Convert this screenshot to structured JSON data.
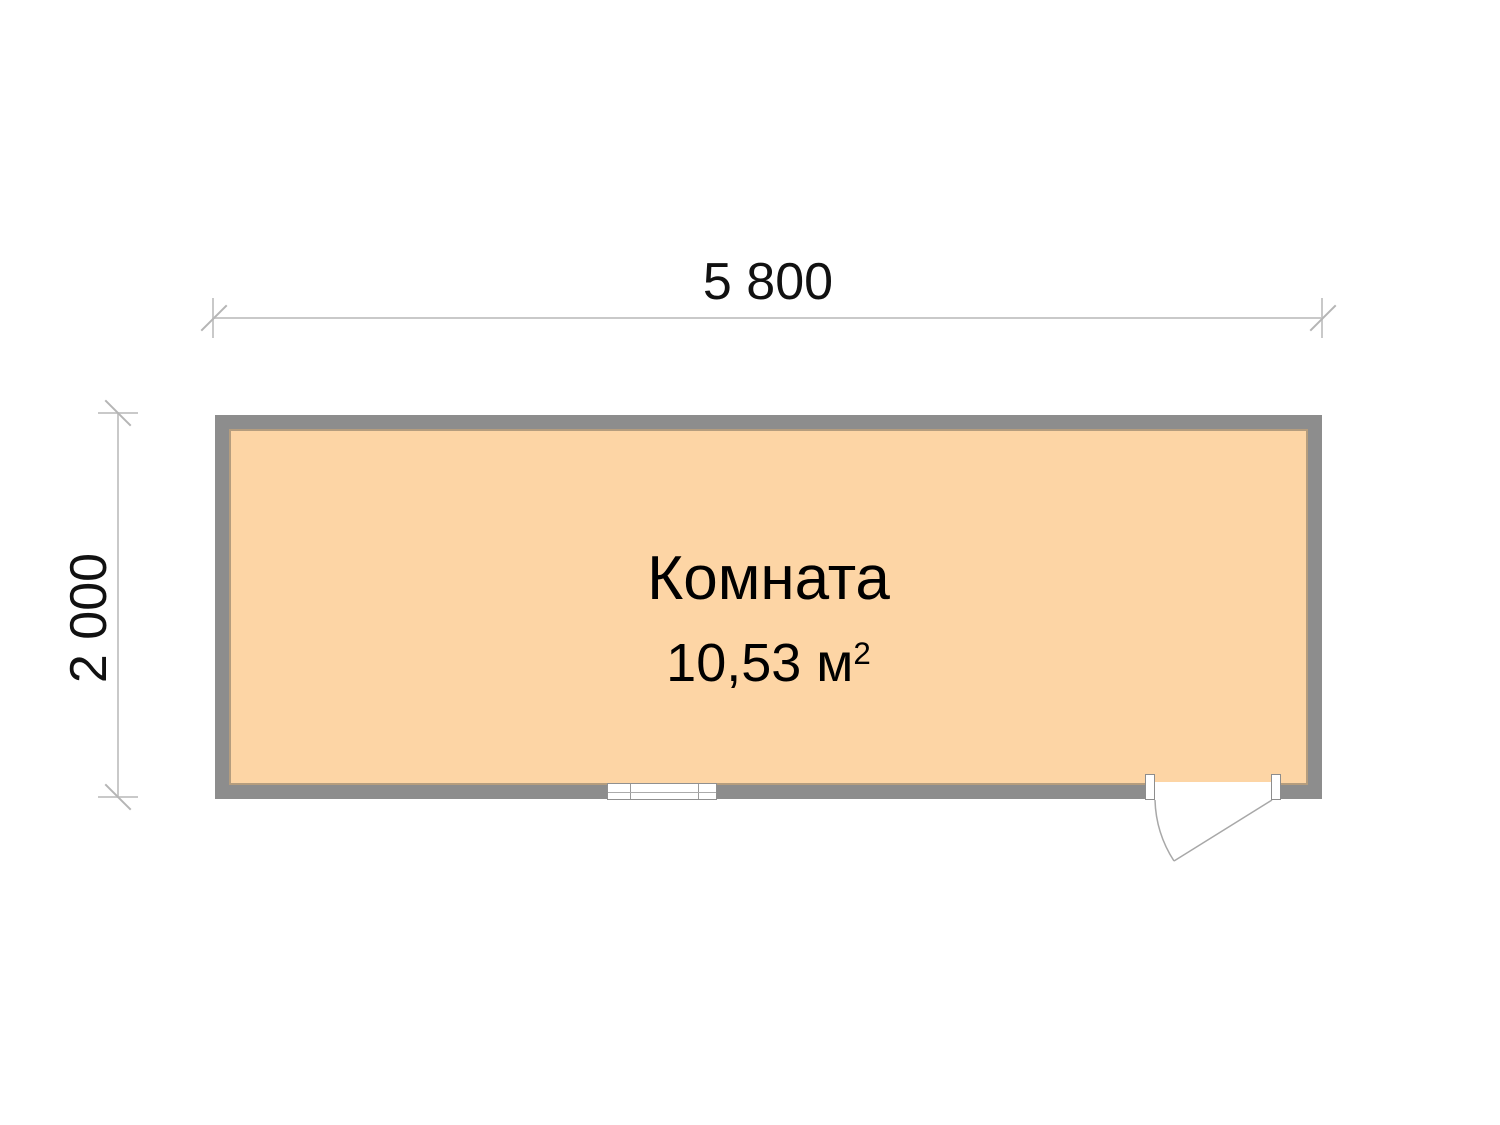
{
  "dimensions": {
    "width_label": "5 800",
    "height_label": "2 000"
  },
  "room": {
    "name": "Комната",
    "area_value": "10,53 м",
    "area_superscript": "2"
  },
  "colors": {
    "wall": "#8d8d8d",
    "room_fill": "#fdd5a5",
    "dimension_line": "#c9c9c9",
    "tick": "#b5b5b5",
    "door_line": "#a8a8a8",
    "text": "#000000",
    "background": "#ffffff"
  }
}
